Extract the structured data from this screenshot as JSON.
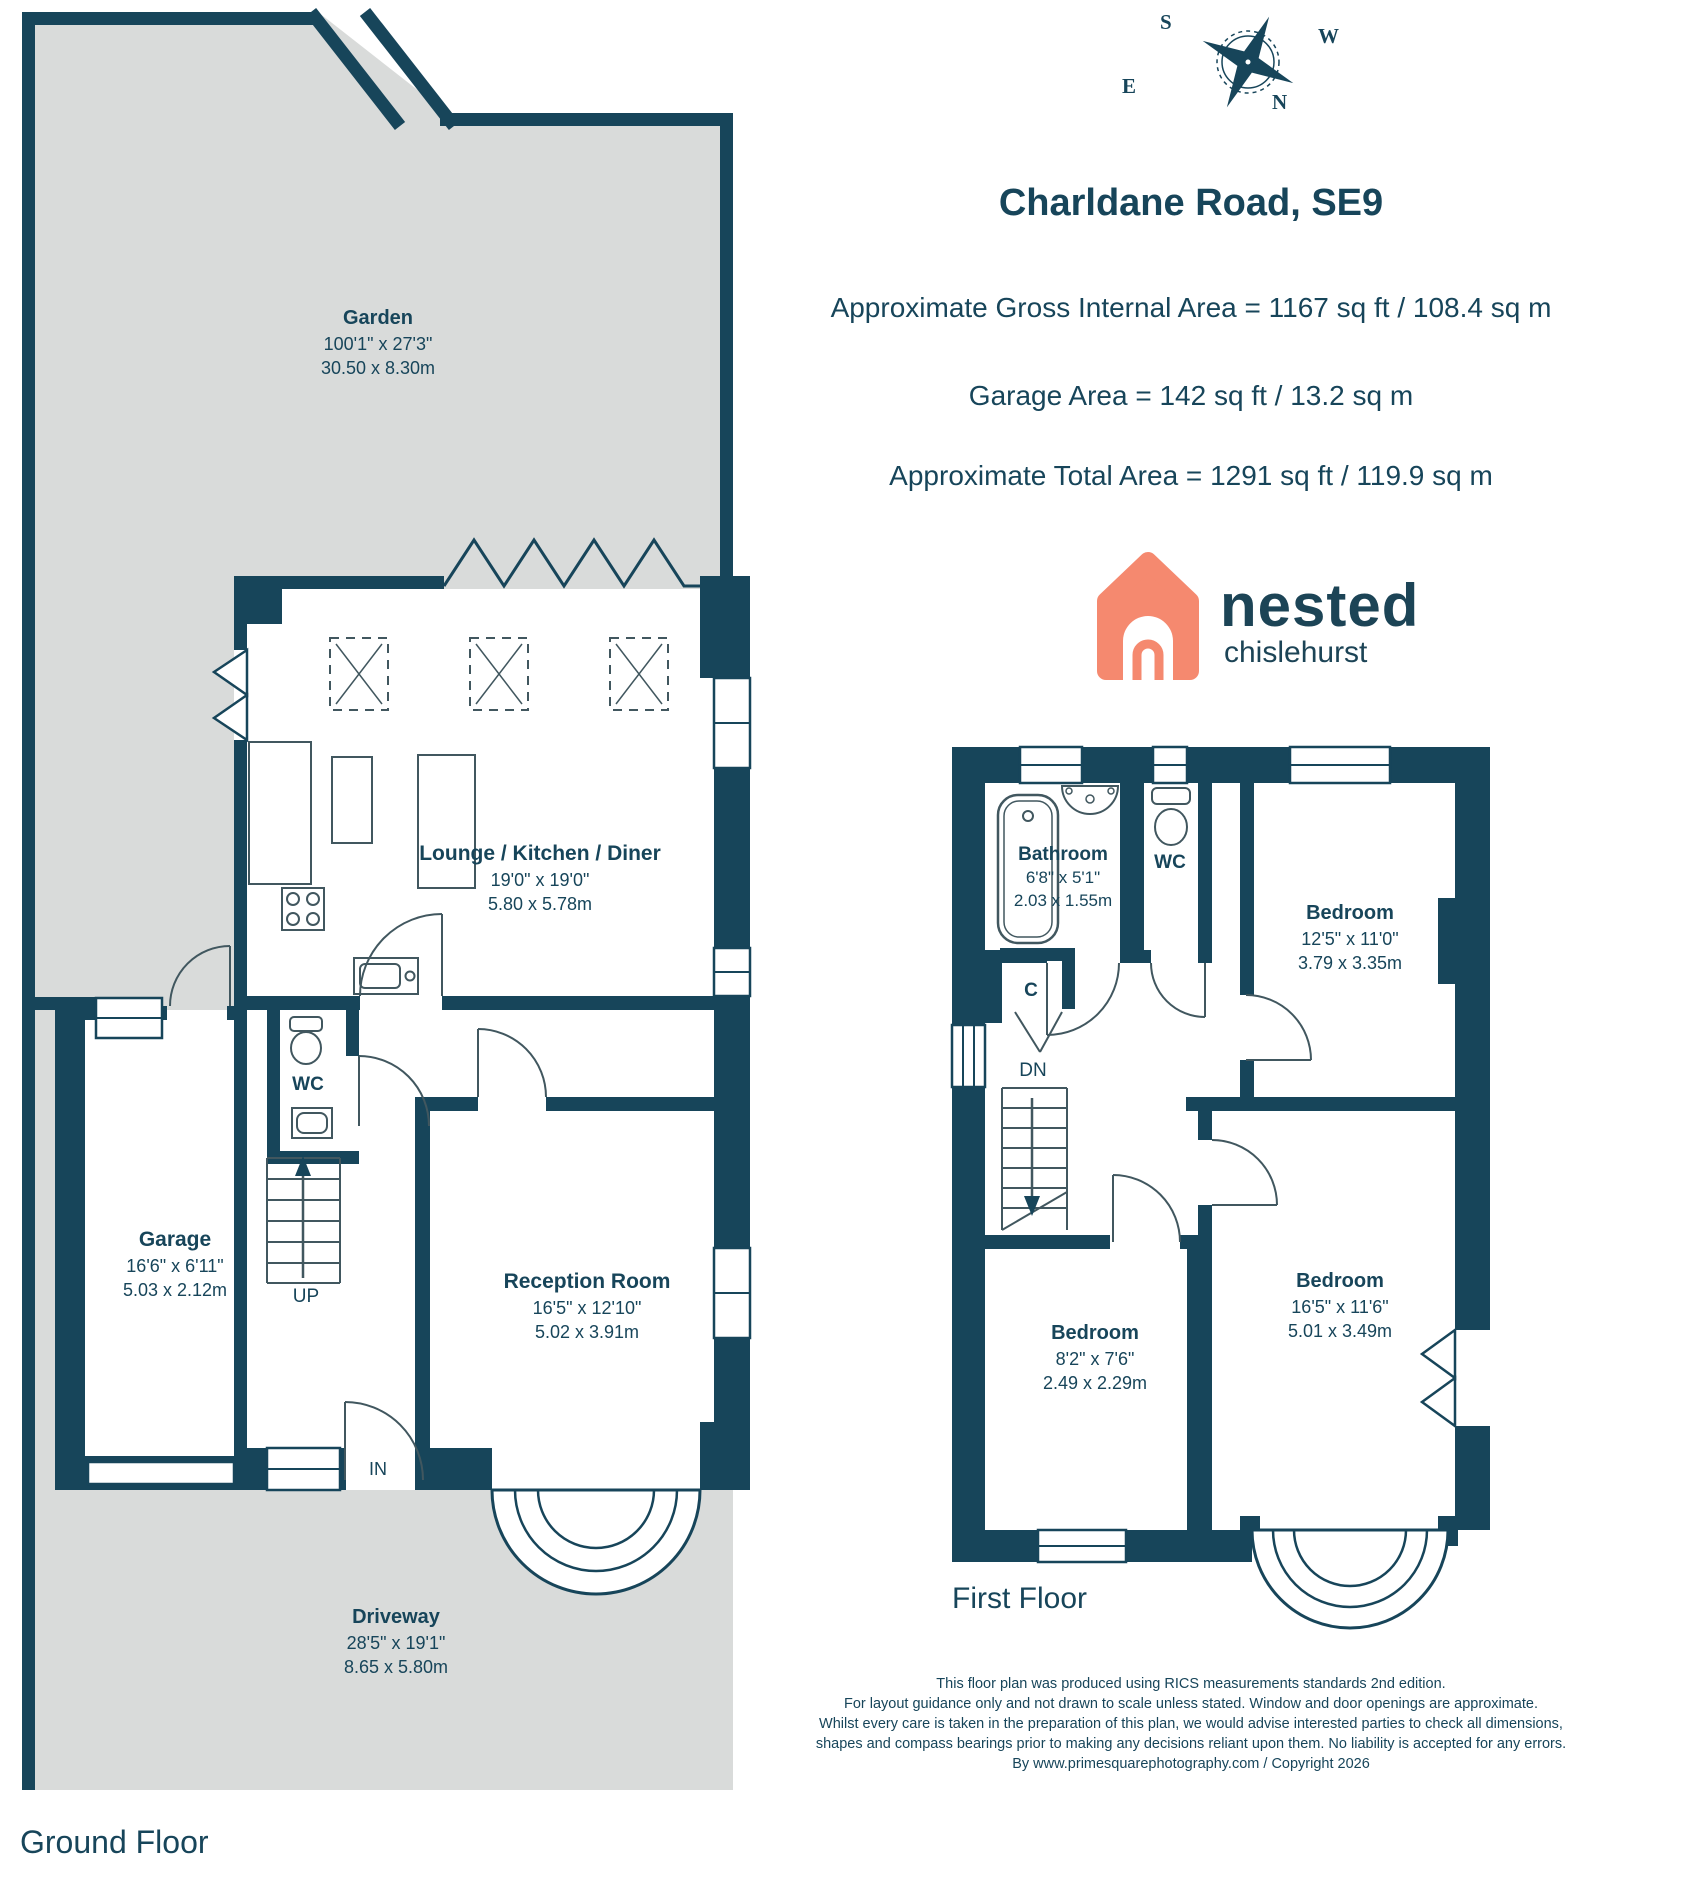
{
  "header": {
    "title": "Charldane Road, SE9",
    "area_lines": [
      "Approximate Gross Internal Area = 1167 sq ft / 108.4 sq m",
      "Garage Area = 142 sq ft / 13.2 sq m",
      "Approximate Total Area = 1291 sq ft / 119.9 sq m"
    ]
  },
  "compass": {
    "top": "S",
    "right": "W",
    "left": "E",
    "bottom": "N"
  },
  "logo": {
    "brand": "nested",
    "location": "chislehurst"
  },
  "ground_floor": {
    "floor_label": "Ground Floor",
    "rooms": {
      "garden": {
        "name": "Garden",
        "imperial": "100'1\" x 27'3\"",
        "metric": "30.50 x 8.30m"
      },
      "lounge": {
        "name": "Lounge / Kitchen / Diner",
        "imperial": "19'0\" x 19'0\"",
        "metric": "5.80 x 5.78m"
      },
      "wc": {
        "name": "WC"
      },
      "garage": {
        "name": "Garage",
        "imperial": "16'6\" x 6'11\"",
        "metric": "5.03 x 2.12m"
      },
      "reception": {
        "name": "Reception Room",
        "imperial": "16'5\" x 12'10\"",
        "metric": "5.02 x 3.91m"
      },
      "driveway": {
        "name": "Driveway",
        "imperial": "28'5\" x 19'1\"",
        "metric": "8.65 x 5.80m"
      }
    },
    "annotations": {
      "up": "UP",
      "in": "IN"
    }
  },
  "first_floor": {
    "floor_label": "First Floor",
    "rooms": {
      "bathroom": {
        "name": "Bathroom",
        "imperial": "6'8\" x 5'1\"",
        "metric": "2.03 x 1.55m"
      },
      "wc": {
        "name": "WC"
      },
      "bedroom_front": {
        "name": "Bedroom",
        "imperial": "12'5\" x 11'0\"",
        "metric": "3.79 x 3.35m"
      },
      "bedroom_small": {
        "name": "Bedroom",
        "imperial": "8'2\" x 7'6\"",
        "metric": "2.49 x 2.29m"
      },
      "bedroom_rear": {
        "name": "Bedroom",
        "imperial": "16'5\" x 11'6\"",
        "metric": "5.01 x 3.49m"
      }
    },
    "annotations": {
      "dn": "DN",
      "closet": "C"
    }
  },
  "disclaimer": {
    "lines": [
      "This floor plan was produced using RICS measurements standards 2nd edition.",
      "For layout guidance only and not drawn to scale unless stated. Window and door openings are approximate.",
      "Whilst every care is taken in the preparation of this plan, we would advise interested parties to check all dimensions,",
      "shapes and compass bearings prior to making any decisions reliant upon them. No liability is accepted for any errors.",
      "By www.primesquarephotography.com / Copyright 2026"
    ]
  },
  "colors": {
    "wall": "#17455A",
    "ground": "#D9DBDA",
    "coral": "#F5896F"
  }
}
